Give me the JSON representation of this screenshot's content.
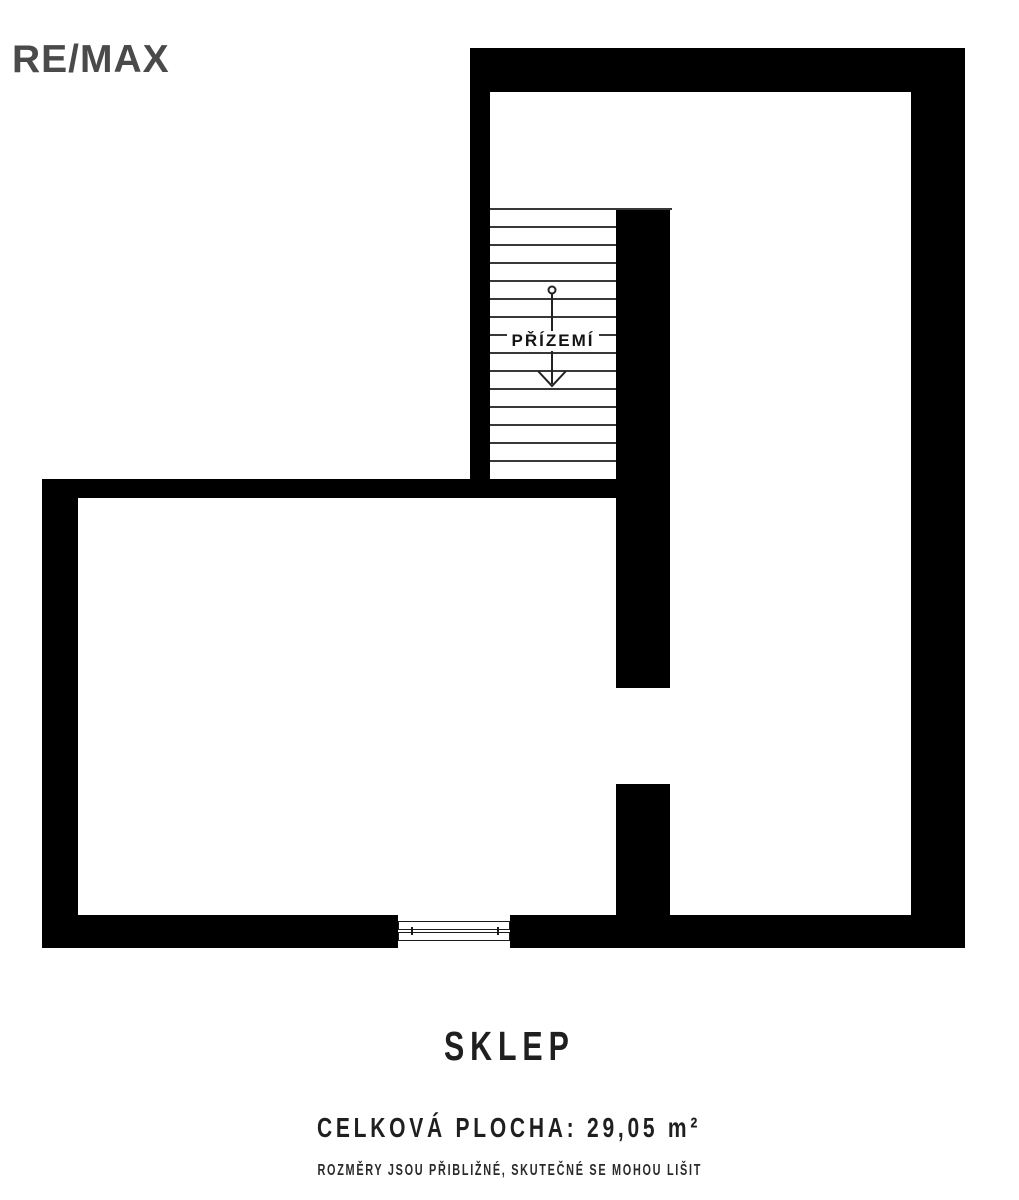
{
  "page": {
    "background": "#ffffff"
  },
  "logo": {
    "text": "RE/MAX",
    "color": "#4a4a4a"
  },
  "floor_plan": {
    "wall_color": "#000000",
    "stair_line_color": "#383838",
    "stair_label": "PŘÍZEMÍ",
    "stair_arrow_direction": "down",
    "stair_tread_count": 15
  },
  "caption": {
    "title": "SKLEP",
    "area_label": "CELKOVÁ PLOCHA: 29,05 m²",
    "disclaimer": "ROZMĚRY JSOU PŘIBLIŽNÉ, SKUTEČNÉ SE MOHOU LIŠIT",
    "text_color": "#1f1f1f"
  }
}
